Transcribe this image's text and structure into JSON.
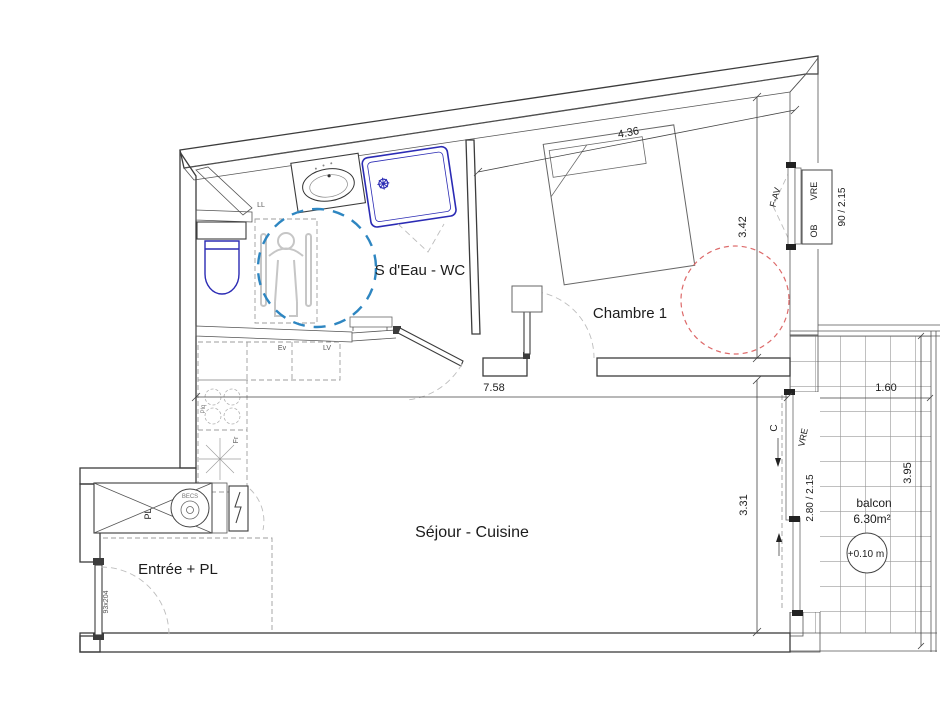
{
  "plan": {
    "rooms": {
      "bathroom": "S d'Eau - WC",
      "bedroom": "Chambre 1",
      "living": "Séjour - Cuisine",
      "entry": "Entrée + PL",
      "balcony": "balcon",
      "balcony_area": "6.30m²",
      "balcony_level": "+0.10 m"
    },
    "dimensions": {
      "bedroom_width": "4.36",
      "bedroom_depth": "3.42",
      "living_width": "7.58",
      "living_depth": "3.31",
      "balcony_width": "1.60",
      "balcony_length": "3.95",
      "bedroom_window_size": "90 / 2.15",
      "balcony_window_size": "2.80 / 2.15",
      "entry_door_size": "93x204"
    },
    "openings": {
      "bedroom_window_type": "F-AV",
      "bedroom_shutter": "VRE",
      "bedroom_shutter_mount": "OB",
      "balcony_shutter": "VRE",
      "balcony_slider_direction": "C"
    },
    "equipment": {
      "washing_machine": "LL",
      "sink": "Ev",
      "dishwasher": "LV",
      "cooktop": "Plq",
      "fridge": "Fr",
      "closet": "PL",
      "water_heater": "BECS"
    },
    "colors": {
      "line": "#3c3c3c",
      "fixture_blue": "#2b2bb4",
      "turning_circle_blue": "#2e86c1",
      "clearance_red": "#dd6a6a",
      "hatch_gray": "#9a9a9a"
    }
  }
}
